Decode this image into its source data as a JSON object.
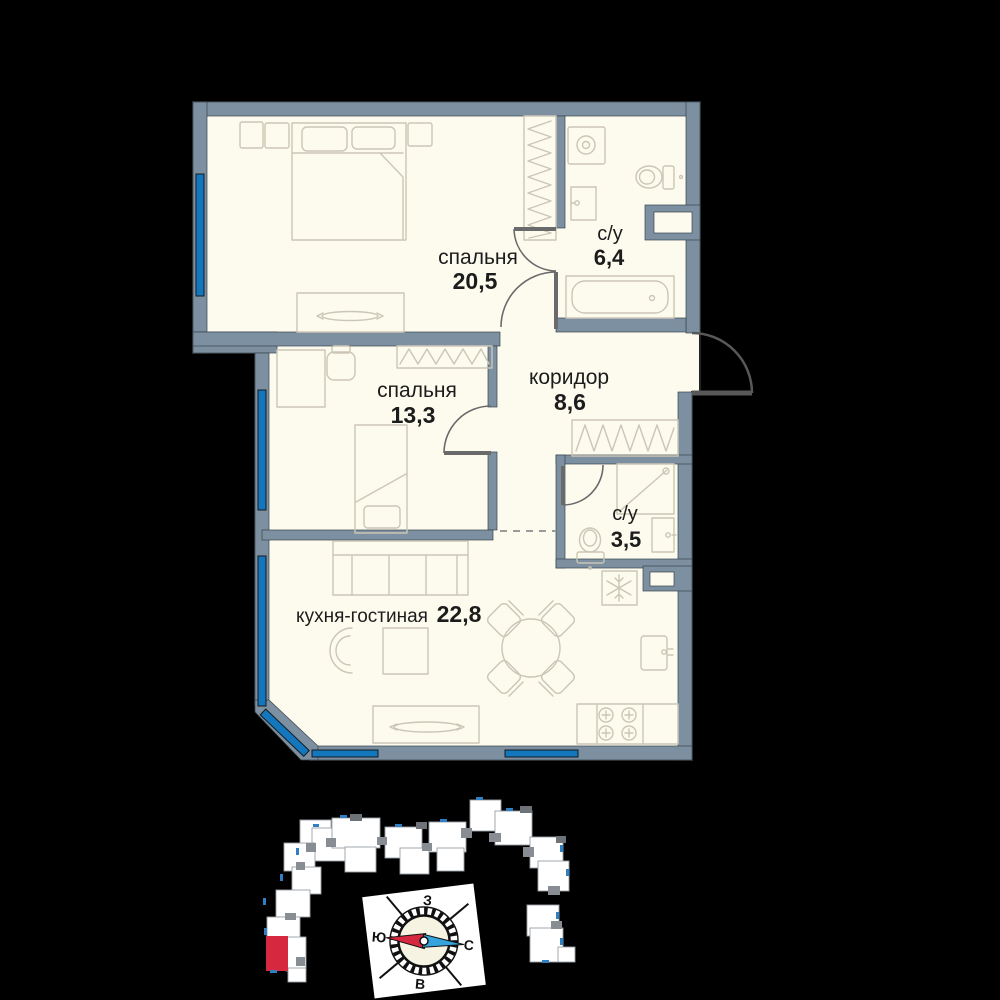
{
  "floorplan": {
    "rooms": [
      {
        "id": "bedroom-1",
        "name": "спальня",
        "area": "20,5"
      },
      {
        "id": "bathroom-1",
        "name": "с/у",
        "area": "6,4"
      },
      {
        "id": "bedroom-2",
        "name": "спальня",
        "area": "13,3"
      },
      {
        "id": "corridor",
        "name": "коридор",
        "area": "8,6"
      },
      {
        "id": "bathroom-2",
        "name": "с/у",
        "area": "3,5"
      },
      {
        "id": "kitchen-living",
        "name": "кухня-гостиная",
        "area": "22,8"
      }
    ],
    "colors": {
      "background": "#000000",
      "wall": "#7C90A1",
      "floor": "#FCFBEE",
      "window_glass": "#1377BD",
      "furniture_line": "#CBC6B5",
      "door_line": "#6A6A6A",
      "label_text": "#1C1C1C",
      "highlighted_unit": "#D6283E",
      "compass_needle_south": "#D6283E",
      "compass_needle_north": "#35A3DC"
    }
  },
  "compass": {
    "west": "З",
    "south": "Ю",
    "north": "С",
    "east": "В"
  }
}
